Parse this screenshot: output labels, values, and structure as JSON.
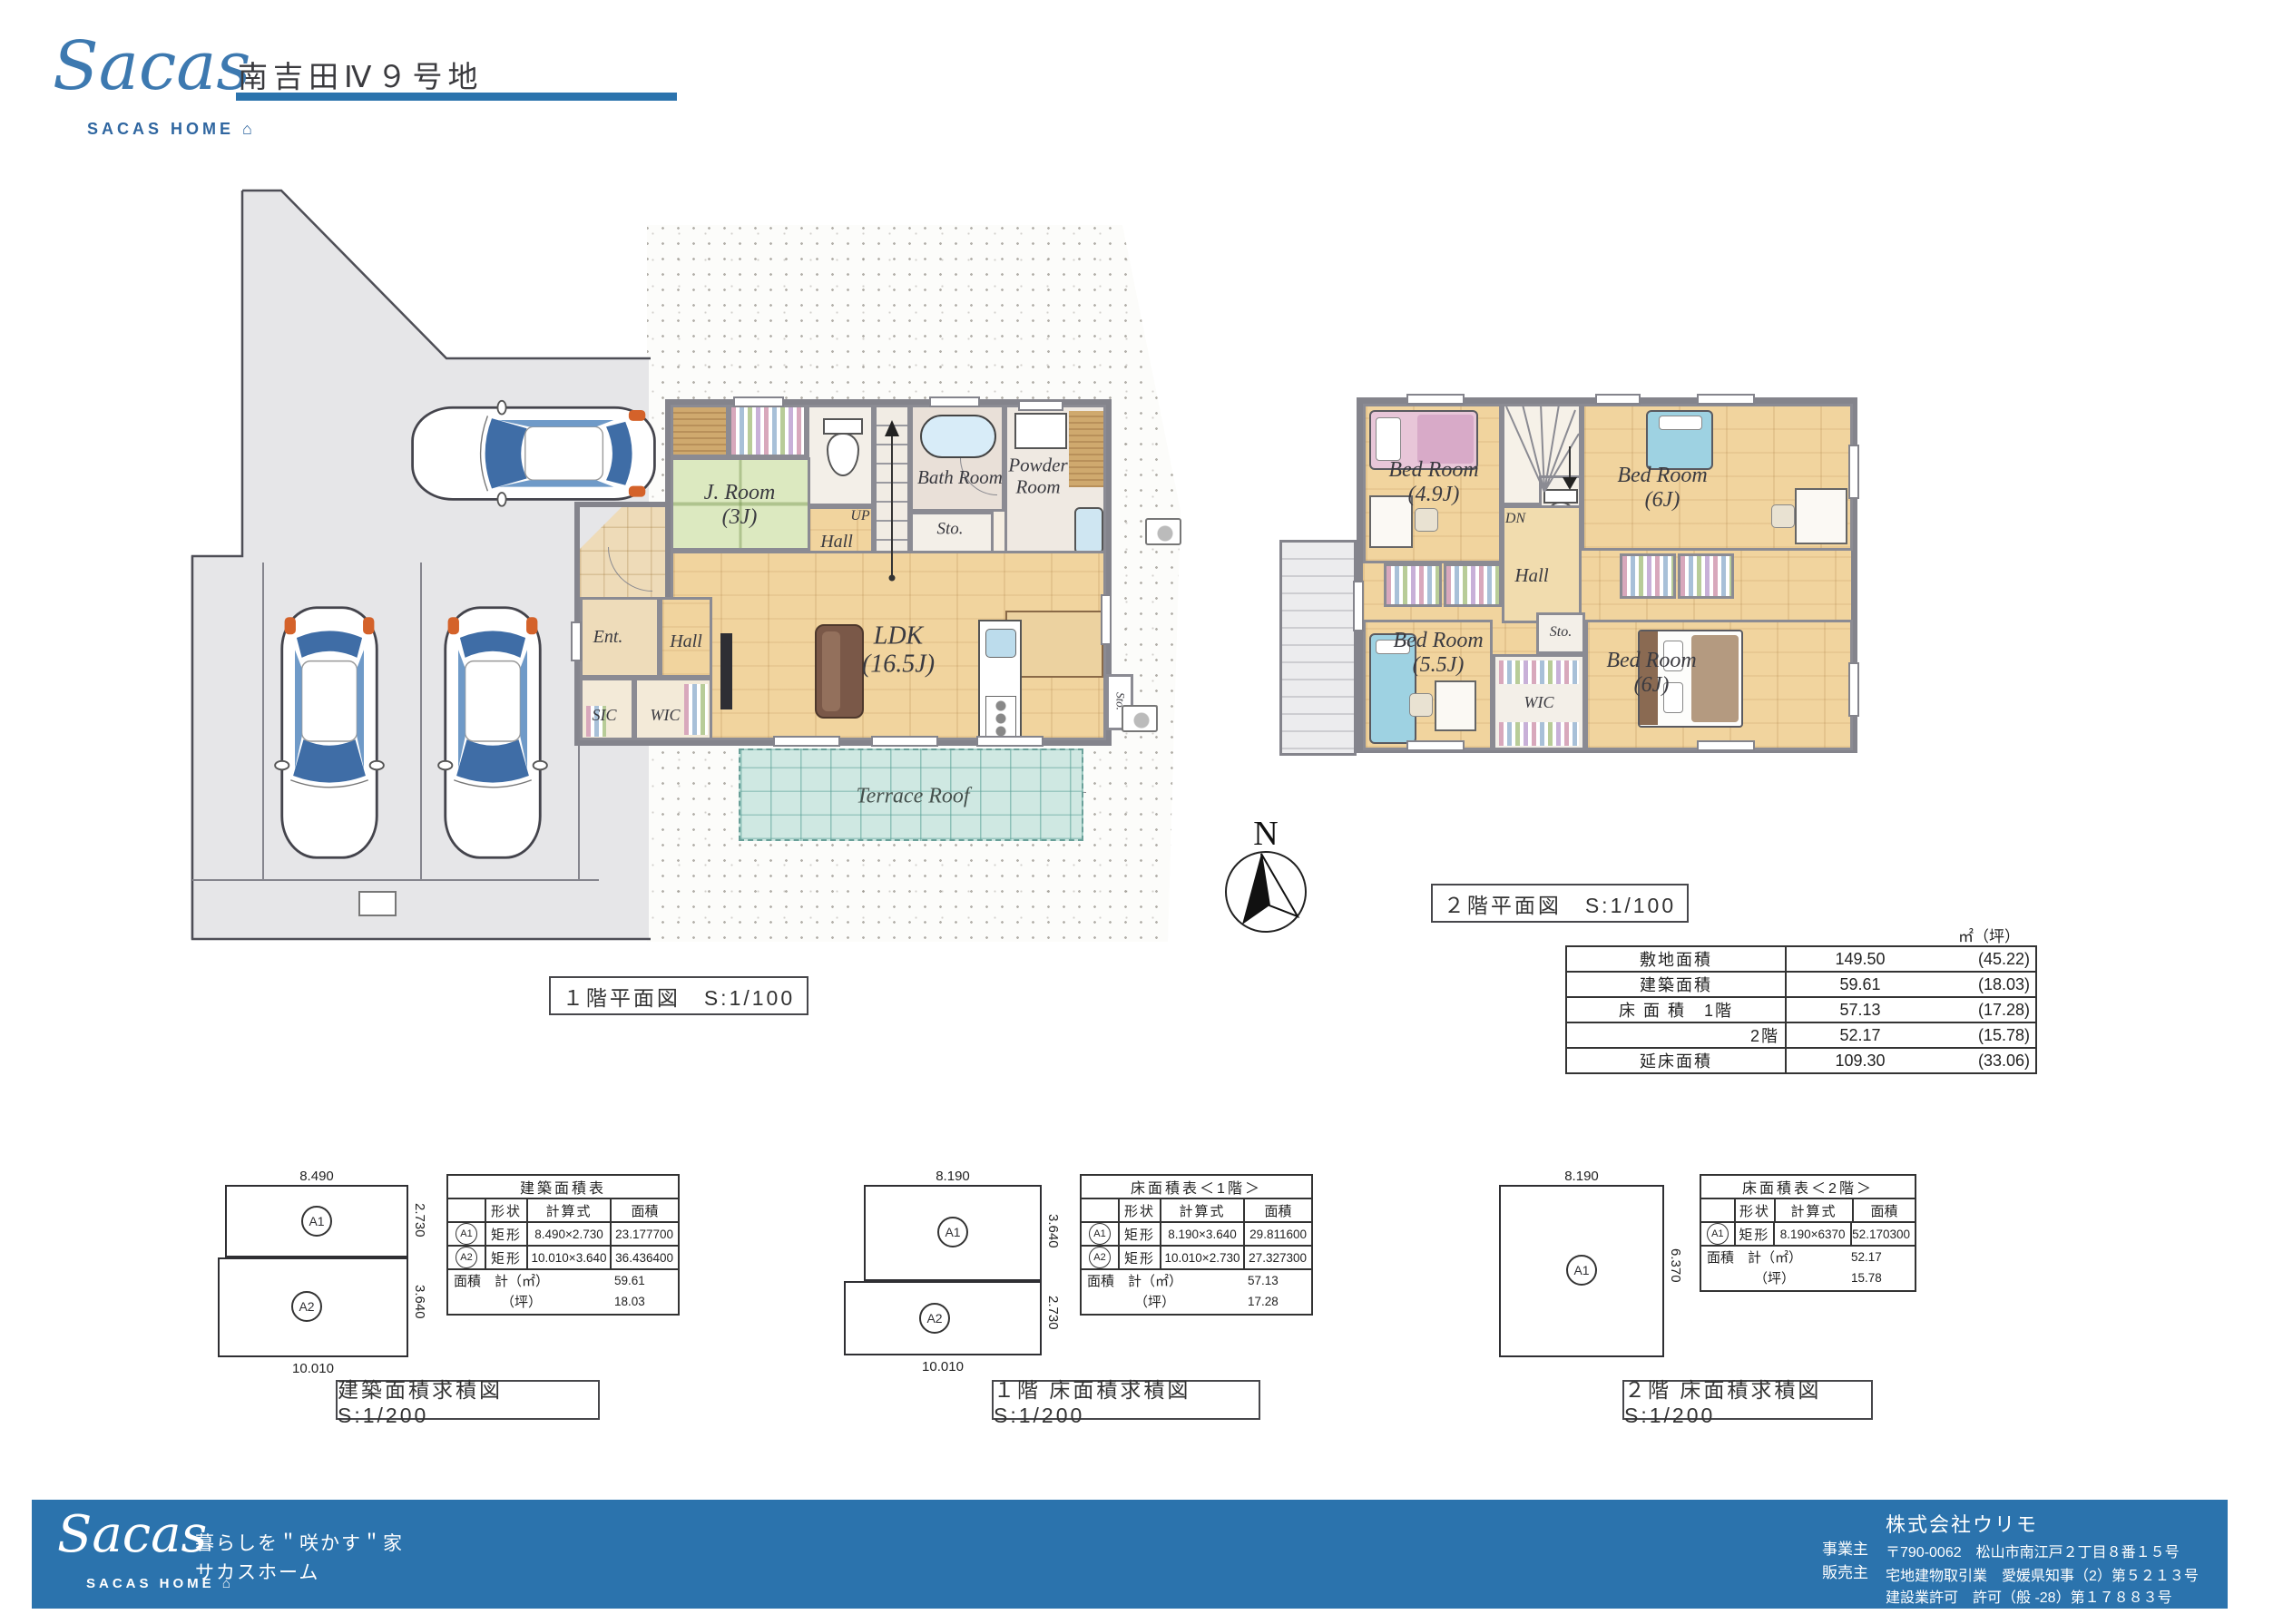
{
  "colors": {
    "brand": "#2b73ad",
    "tatami": "#dce9c0",
    "wood": "#f1d49e",
    "terrace": "#cfe8e2"
  },
  "header": {
    "script": "Sacas",
    "wordmark": "SACAS HOME",
    "house": "⌂",
    "title": "南吉田Ⅳ９号地"
  },
  "compass": {
    "n": "N"
  },
  "plan1f": {
    "caption": "１階平面図　S:1/100",
    "rooms": {
      "jroom": "J. Room",
      "jroom_size": "(3J)",
      "bath": "Bath Room",
      "powder1": "Powder",
      "powder2": "Room",
      "sto_top": "Sto.",
      "up": "UP",
      "hall_stairs": "Hall",
      "ent": "Ent.",
      "hall_entry": "Hall",
      "sic": "SIC",
      "wic": "WIC",
      "ldk": "LDK",
      "ldk_size": "(16.5J)",
      "sto_kitchen": "Sto.",
      "terrace": "Terrace Roof"
    }
  },
  "plan2f": {
    "caption": "２階平面図　S:1/100",
    "rooms": {
      "br1": "Bed Room",
      "br1_size": "(4.9J)",
      "br2": "Bed Room",
      "br2_size": "(6J)",
      "br3": "Bed Room",
      "br3_size": "(5.5J)",
      "br4": "Bed Room",
      "br4_size": "(6J)",
      "hall": "Hall",
      "dn": "DN",
      "sto": "Sto.",
      "wic": "WIC"
    }
  },
  "summary": {
    "unit": "㎡（坪）",
    "rows": [
      {
        "label": "敷地面積",
        "value": "149.50",
        "tsubo": "(45.22)"
      },
      {
        "label": "建築面積",
        "value": "59.61",
        "tsubo": "(18.03)"
      },
      {
        "label": "床 面 積　1階",
        "value": "57.13",
        "tsubo": "(17.28)"
      },
      {
        "label": "2階",
        "value": "52.17",
        "tsubo": "(15.78)"
      },
      {
        "label": "延床面積",
        "value": "109.30",
        "tsubo": "(33.06)"
      }
    ]
  },
  "calc": [
    {
      "caption": "建築面積求積図　S:1/200",
      "title": "建築面積表",
      "col_shape": "形状",
      "col_formula": "計算式",
      "col_area": "面積",
      "rows": [
        {
          "id": "A1",
          "shape": "矩形",
          "formula": "8.490×2.730",
          "area": "23.177700"
        },
        {
          "id": "A2",
          "shape": "矩形",
          "formula": "10.010×3.640",
          "area": "36.436400"
        }
      ],
      "total_label": "面積　計（㎡）",
      "total_value": "59.61",
      "tsubo_label": "（坪）",
      "tsubo_value": "18.03",
      "dims": {
        "top": "8.490",
        "right1": "2.730",
        "right2": "3.640",
        "bottom": "10.010",
        "id1": "A1",
        "id2": "A2"
      }
    },
    {
      "caption": "１階 床面積求積図　S:1/200",
      "title": "床面積表＜1階＞",
      "col_shape": "形状",
      "col_formula": "計算式",
      "col_area": "面積",
      "rows": [
        {
          "id": "A1",
          "shape": "矩形",
          "formula": "8.190×3.640",
          "area": "29.811600"
        },
        {
          "id": "A2",
          "shape": "矩形",
          "formula": "10.010×2.730",
          "area": "27.327300"
        }
      ],
      "total_label": "面積　計（㎡）",
      "total_value": "57.13",
      "tsubo_label": "（坪）",
      "tsubo_value": "17.28",
      "dims": {
        "top": "8.190",
        "right1": "3.640",
        "right2": "2.730",
        "bottom": "10.010",
        "id1": "A1",
        "id2": "A2"
      }
    },
    {
      "caption": "２階 床面積求積図　S:1/200",
      "title": "床面積表＜2階＞",
      "col_shape": "形状",
      "col_formula": "計算式",
      "col_area": "面積",
      "rows": [
        {
          "id": "A1",
          "shape": "矩形",
          "formula": "8.190×6370",
          "area": "52.170300"
        }
      ],
      "total_label": "面積　計（㎡）",
      "total_value": "52.17",
      "tsubo_label": "（坪）",
      "tsubo_value": "15.78",
      "dims": {
        "top": "8.190",
        "right1": "6.370",
        "id1": "A1"
      }
    }
  ],
  "footer": {
    "script": "Sacas",
    "wordmark": "SACAS HOME",
    "house": "⌂",
    "tagline1": "暮らしを＂咲かす＂家",
    "tagline2": "サカスホーム",
    "role1": "事業主",
    "role2": "販売主",
    "company": "株式会社ウリモ",
    "address": "〒790-0062　松山市南江戸２丁目８番１５号",
    "license1": "宅地建物取引業　愛媛県知事（2）第５２１３号",
    "license2": "建設業許可　許可（般 -28）第１７８８３号"
  }
}
